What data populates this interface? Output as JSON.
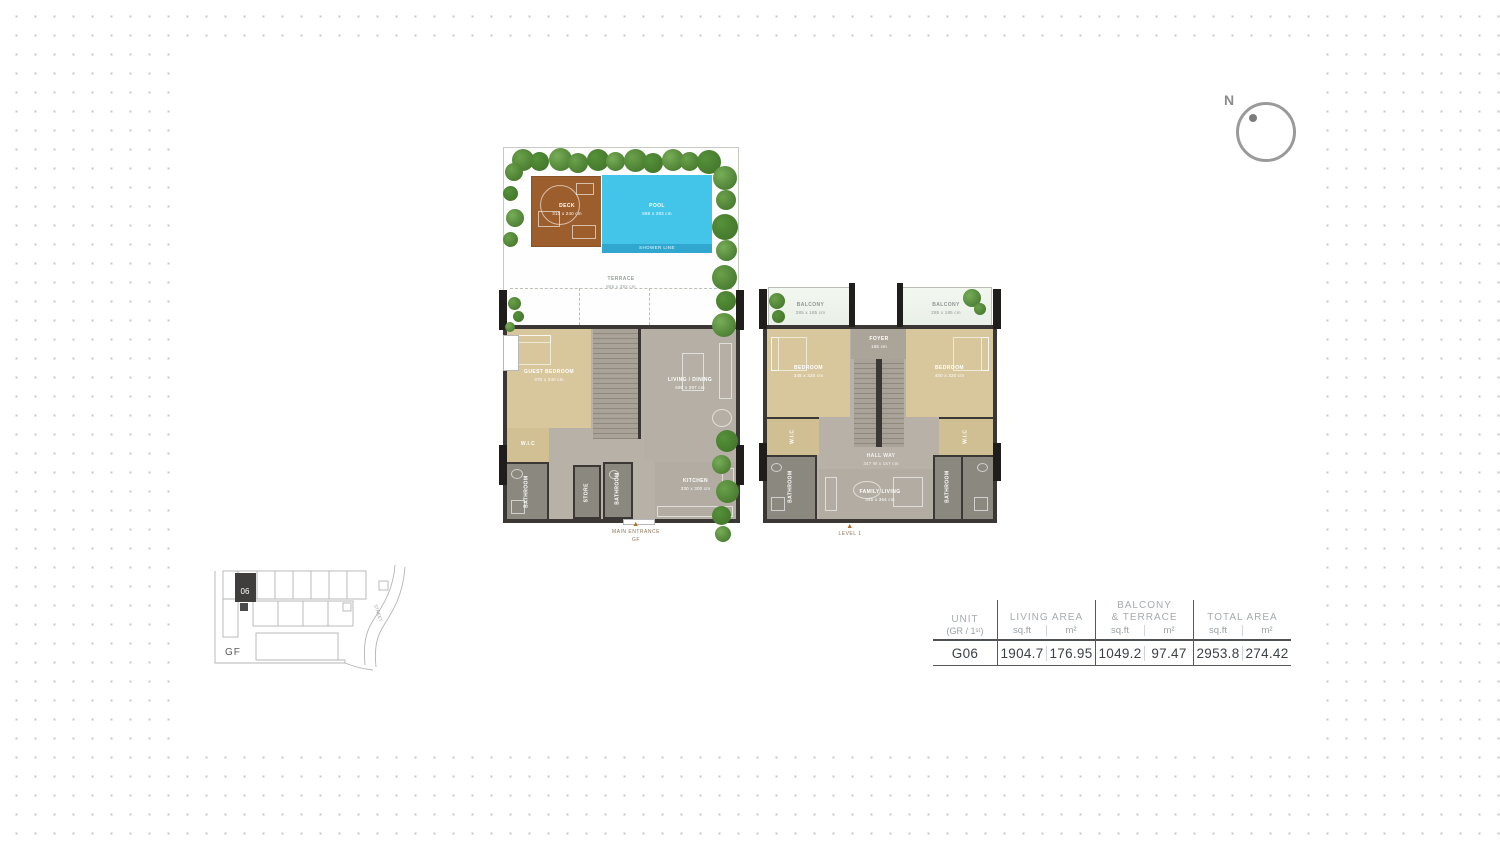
{
  "compass": {
    "north_label": "N"
  },
  "ground_floor_plan": {
    "marker": {
      "arrow": "▲",
      "title": "MAIN ENTRANCE",
      "subtitle": "GF"
    },
    "outdoor": {
      "deck_label": "DECK",
      "deck_dims": "310 x 240 cm",
      "pool_label": "POOL",
      "pool_dims": "888 x 393 cm",
      "pool_edge_label": "SHOWER LINE",
      "terrace_label": "TERRACE",
      "terrace_dims": "865 x 393 cm"
    },
    "rooms": {
      "guest_bedroom_label": "GUEST BEDROOM",
      "guest_bedroom_dims": "370 x 340 cm",
      "wic_label": "W.I.C",
      "living_dining_label": "LIVING / DINING",
      "living_dining_dims": "590 x 397 cm",
      "kitchen_label": "KITCHEN",
      "kitchen_dims": "330 x 300 cm",
      "bathroom_label": "BATHROOM",
      "bathroom_dims": "245 x 155 cm",
      "store_label": "STORE",
      "store_dims": "160 x 150 cm",
      "guest_bathroom_label": "BATHROOM",
      "guest_bathroom_dims": "200 x 150 cm"
    }
  },
  "level1_plan": {
    "marker": {
      "arrow": "▲",
      "title": "LEVEL 1"
    },
    "rooms": {
      "balcony_left_label": "BALCONY",
      "balcony_left_dims": "285 x 185 cm",
      "balcony_right_label": "BALCONY",
      "balcony_right_dims": "285 x 185 cm",
      "bedroom_left_label": "BEDROOM",
      "bedroom_left_dims": "345 x 320 cm",
      "bedroom_right_label": "BEDROOM",
      "bedroom_right_dims": "400 x 320 cm",
      "foyer_label": "FOYER",
      "foyer_dims": "165 cm",
      "hallway_label": "HALL WAY",
      "hallway_dims": "347 W x 157 cm",
      "family_living_label": "FAMILY LIVING",
      "family_living_dims": "345 x 364 cm",
      "bathroom_left_label": "BATHROOM",
      "bathroom_left_dims": "307 x 155 cm",
      "bathroom_right_label": "BATHROOM",
      "bathroom_right_dims": "245 x 155 cm",
      "wic_left_label": "W.I.C",
      "wic_right_label": "W.I.C"
    }
  },
  "key_plan": {
    "floor_label": "GF",
    "highlighted_unit": "06",
    "street_label": "STREET"
  },
  "area_table": {
    "unit": {
      "title": "UNIT",
      "subtitle": "(GR / 1ˢᵗ)"
    },
    "living": {
      "title": "LIVING AREA",
      "sqft_header": "sq.ft",
      "sqm_header": "m²"
    },
    "balcony": {
      "title_line1": "BALCONY",
      "title_line2": "& TERRACE",
      "sqft_header": "sq.ft",
      "sqm_header": "m²"
    },
    "total": {
      "title": "TOTAL AREA",
      "sqft_header": "sq.ft",
      "sqm_header": "m²"
    },
    "row": {
      "unit": "G06",
      "living_sqft": "1904.7",
      "living_sqm": "176.95",
      "balcony_sqft": "1049.2",
      "balcony_sqm": "97.47",
      "total_sqft": "2953.8",
      "total_sqm": "274.42"
    }
  }
}
